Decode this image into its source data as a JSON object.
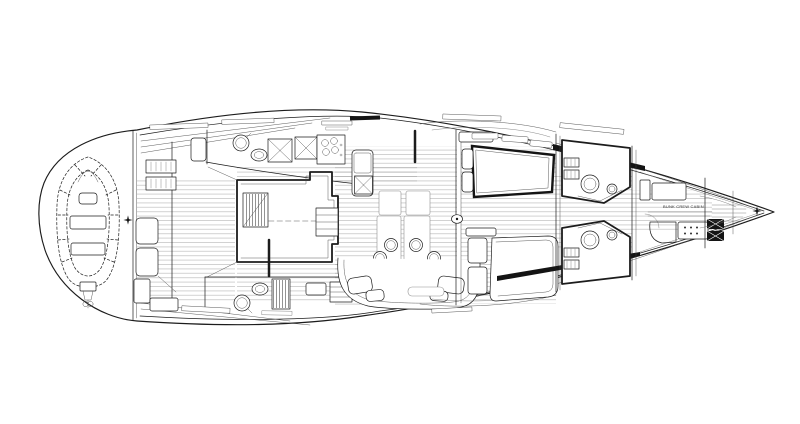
{
  "diagram": {
    "type": "yacht-deck-plan",
    "view": "top-down interior arrangement plan of a sailing yacht, bow pointing right",
    "labels": {
      "crew_cabin": "BUNK CREW CABIN"
    },
    "markers": {
      "stern_centerline_symbol": "four-pointed-star",
      "bow_centerline_symbol": "four-pointed-star"
    },
    "colors": {
      "background": "#ffffff",
      "line": "#1c1c1c",
      "light_line": "#8f8f8f",
      "dark_fill": "#141414"
    },
    "features": [
      "hull-outline",
      "stern-garage-with-inflatable-tender",
      "tender-outboard-motor",
      "aft-port-head-toilet-sink",
      "aft-starboard-head-toilet-sink",
      "shower-grating",
      "companionway-stairs",
      "engine-room-box",
      "galley-sinks-and-stove",
      "salon-dining-tables",
      "seven-dining-chairs",
      "curved-settee-with-pillows",
      "mast-section",
      "port-forward-double-berth",
      "starboard-forward-double-berth",
      "port-forward-head",
      "starboard-forward-head",
      "crew-bunks",
      "bow-sail-locker"
    ]
  }
}
